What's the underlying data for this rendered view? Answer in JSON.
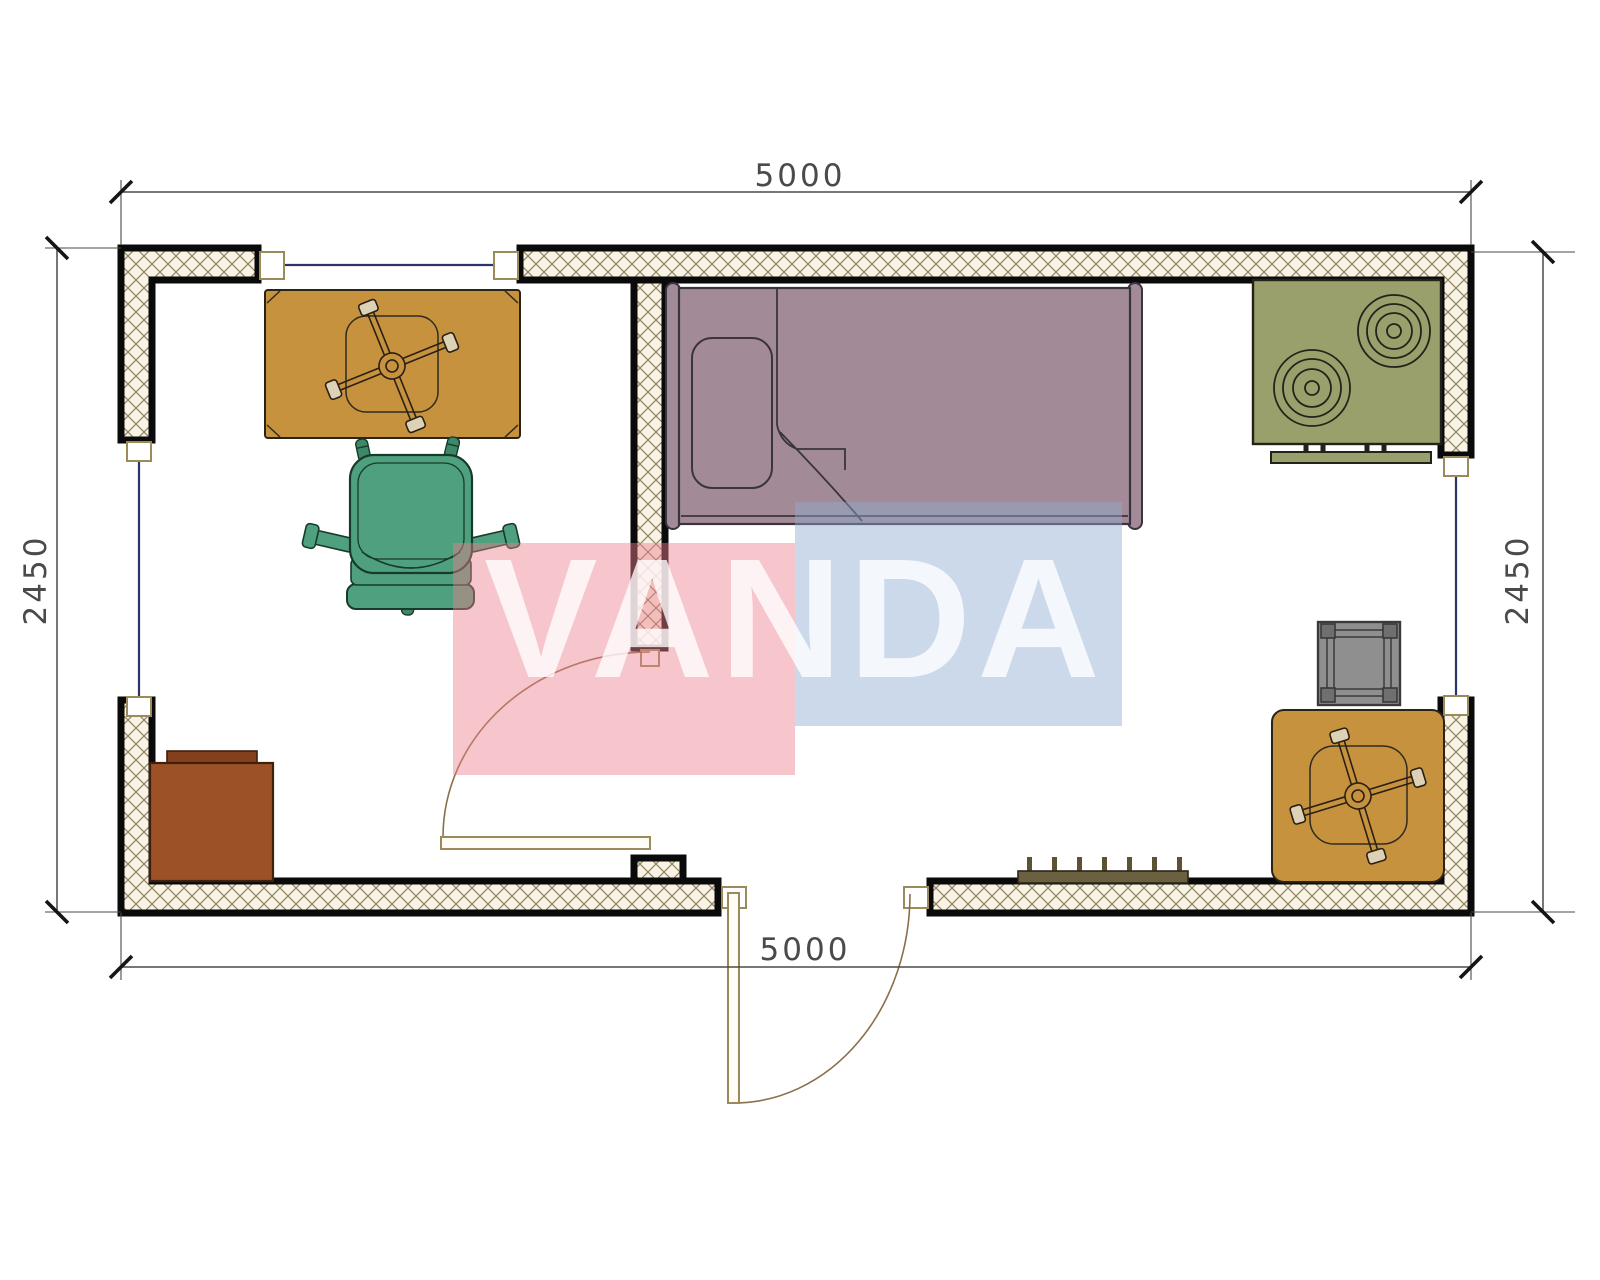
{
  "title": "Container cabin floor plan 5000 x 2450",
  "dimensions": {
    "top": "5000",
    "bottom": "5000",
    "left": "2450",
    "right": "2450"
  },
  "watermark": {
    "text": "VANDA"
  },
  "colors": {
    "hatch_bg": "#f8f3e4",
    "hatch_line": "#8f835f",
    "wall_edge": "#0a0a0a",
    "window_line": "#2a3569",
    "door_frame": "#9b8a5a",
    "door_swing": "#8a6f4a",
    "dimension_text": "#4a4a4a",
    "table": "#c7923e",
    "table_outline": "#41320f",
    "pedestal_pad": "#ddd2b6",
    "chair": "#4fa07e",
    "chair_dark": "#3d8868",
    "bed": "#a28a96",
    "bed_outline": "#3a3340",
    "stove": "#9aa06c",
    "stove_outline": "#23231a",
    "stool": "#8f8f8f",
    "stool_leg": "#6f6f6f",
    "cabinet": "#9c5126",
    "cabinet_lid": "#84401c",
    "radiator": "#6b6140",
    "radiator_tick": "#5c5335",
    "watermark_pink": "rgba(238,127,142,0.45)",
    "watermark_blue": "rgba(142,171,209,0.45)",
    "watermark_text_color": "rgba(255,255,255,0.78)"
  }
}
